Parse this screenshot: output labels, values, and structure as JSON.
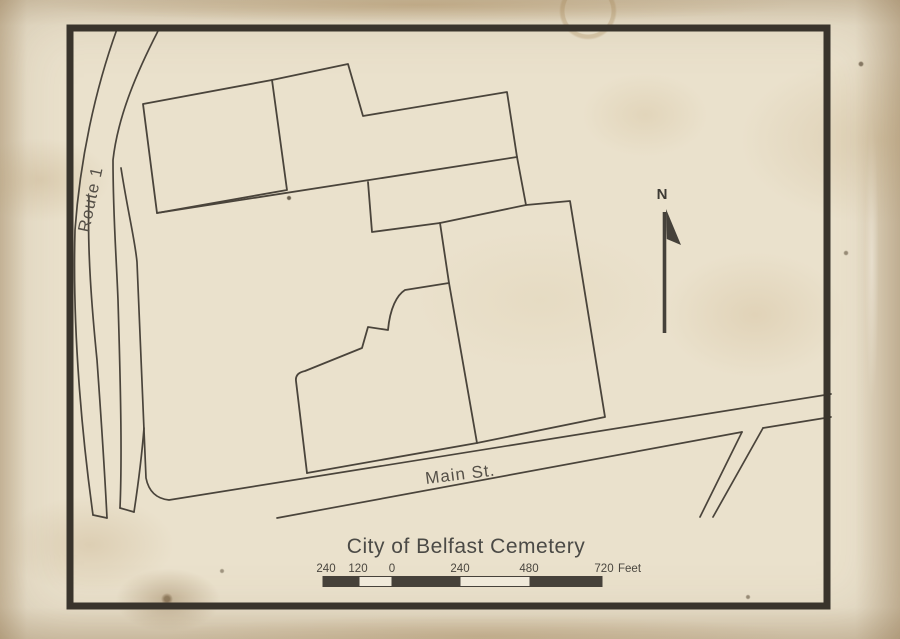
{
  "map": {
    "title": "City of Belfast Cemetery",
    "north_label": "N",
    "route1_label": "Route 1",
    "main_st_label": "Main St.",
    "colors": {
      "paper": "#eae1cc",
      "boundary_line": "#4a443b",
      "frame": "#39342c",
      "highlight_parcel": "#a9c6de"
    }
  },
  "scalebar": {
    "labels": [
      "240",
      "120",
      "0",
      "240",
      "480",
      "720"
    ],
    "unit": "Feet"
  }
}
